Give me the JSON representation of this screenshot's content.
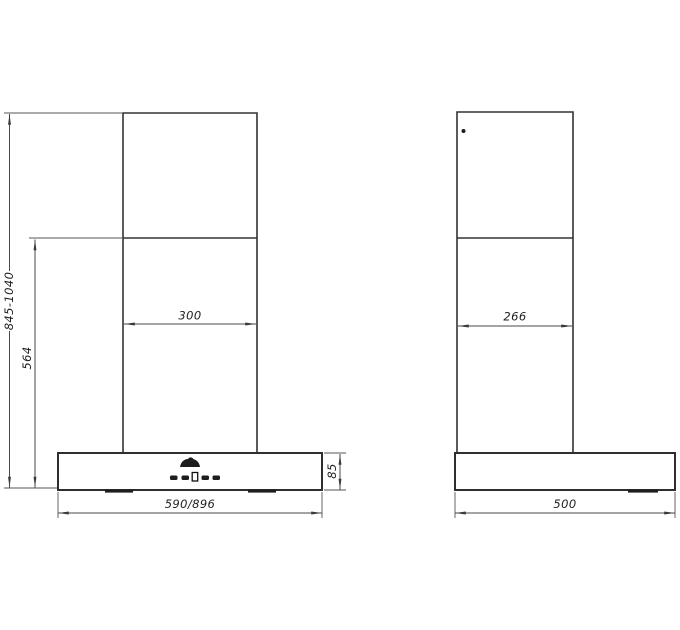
{
  "colors": {
    "background": "#ffffff",
    "outline": "#333333",
    "dimension_line": "#4a4a4a",
    "text": "#1f1f1f"
  },
  "front_view": {
    "dimensions": {
      "total_height_range": "845-1040",
      "mount_height": "564",
      "chimney_width": "300",
      "body_width": "590/896",
      "body_height": "85"
    }
  },
  "side_view": {
    "dimensions": {
      "chimney_depth": "266",
      "body_depth": "500"
    }
  }
}
